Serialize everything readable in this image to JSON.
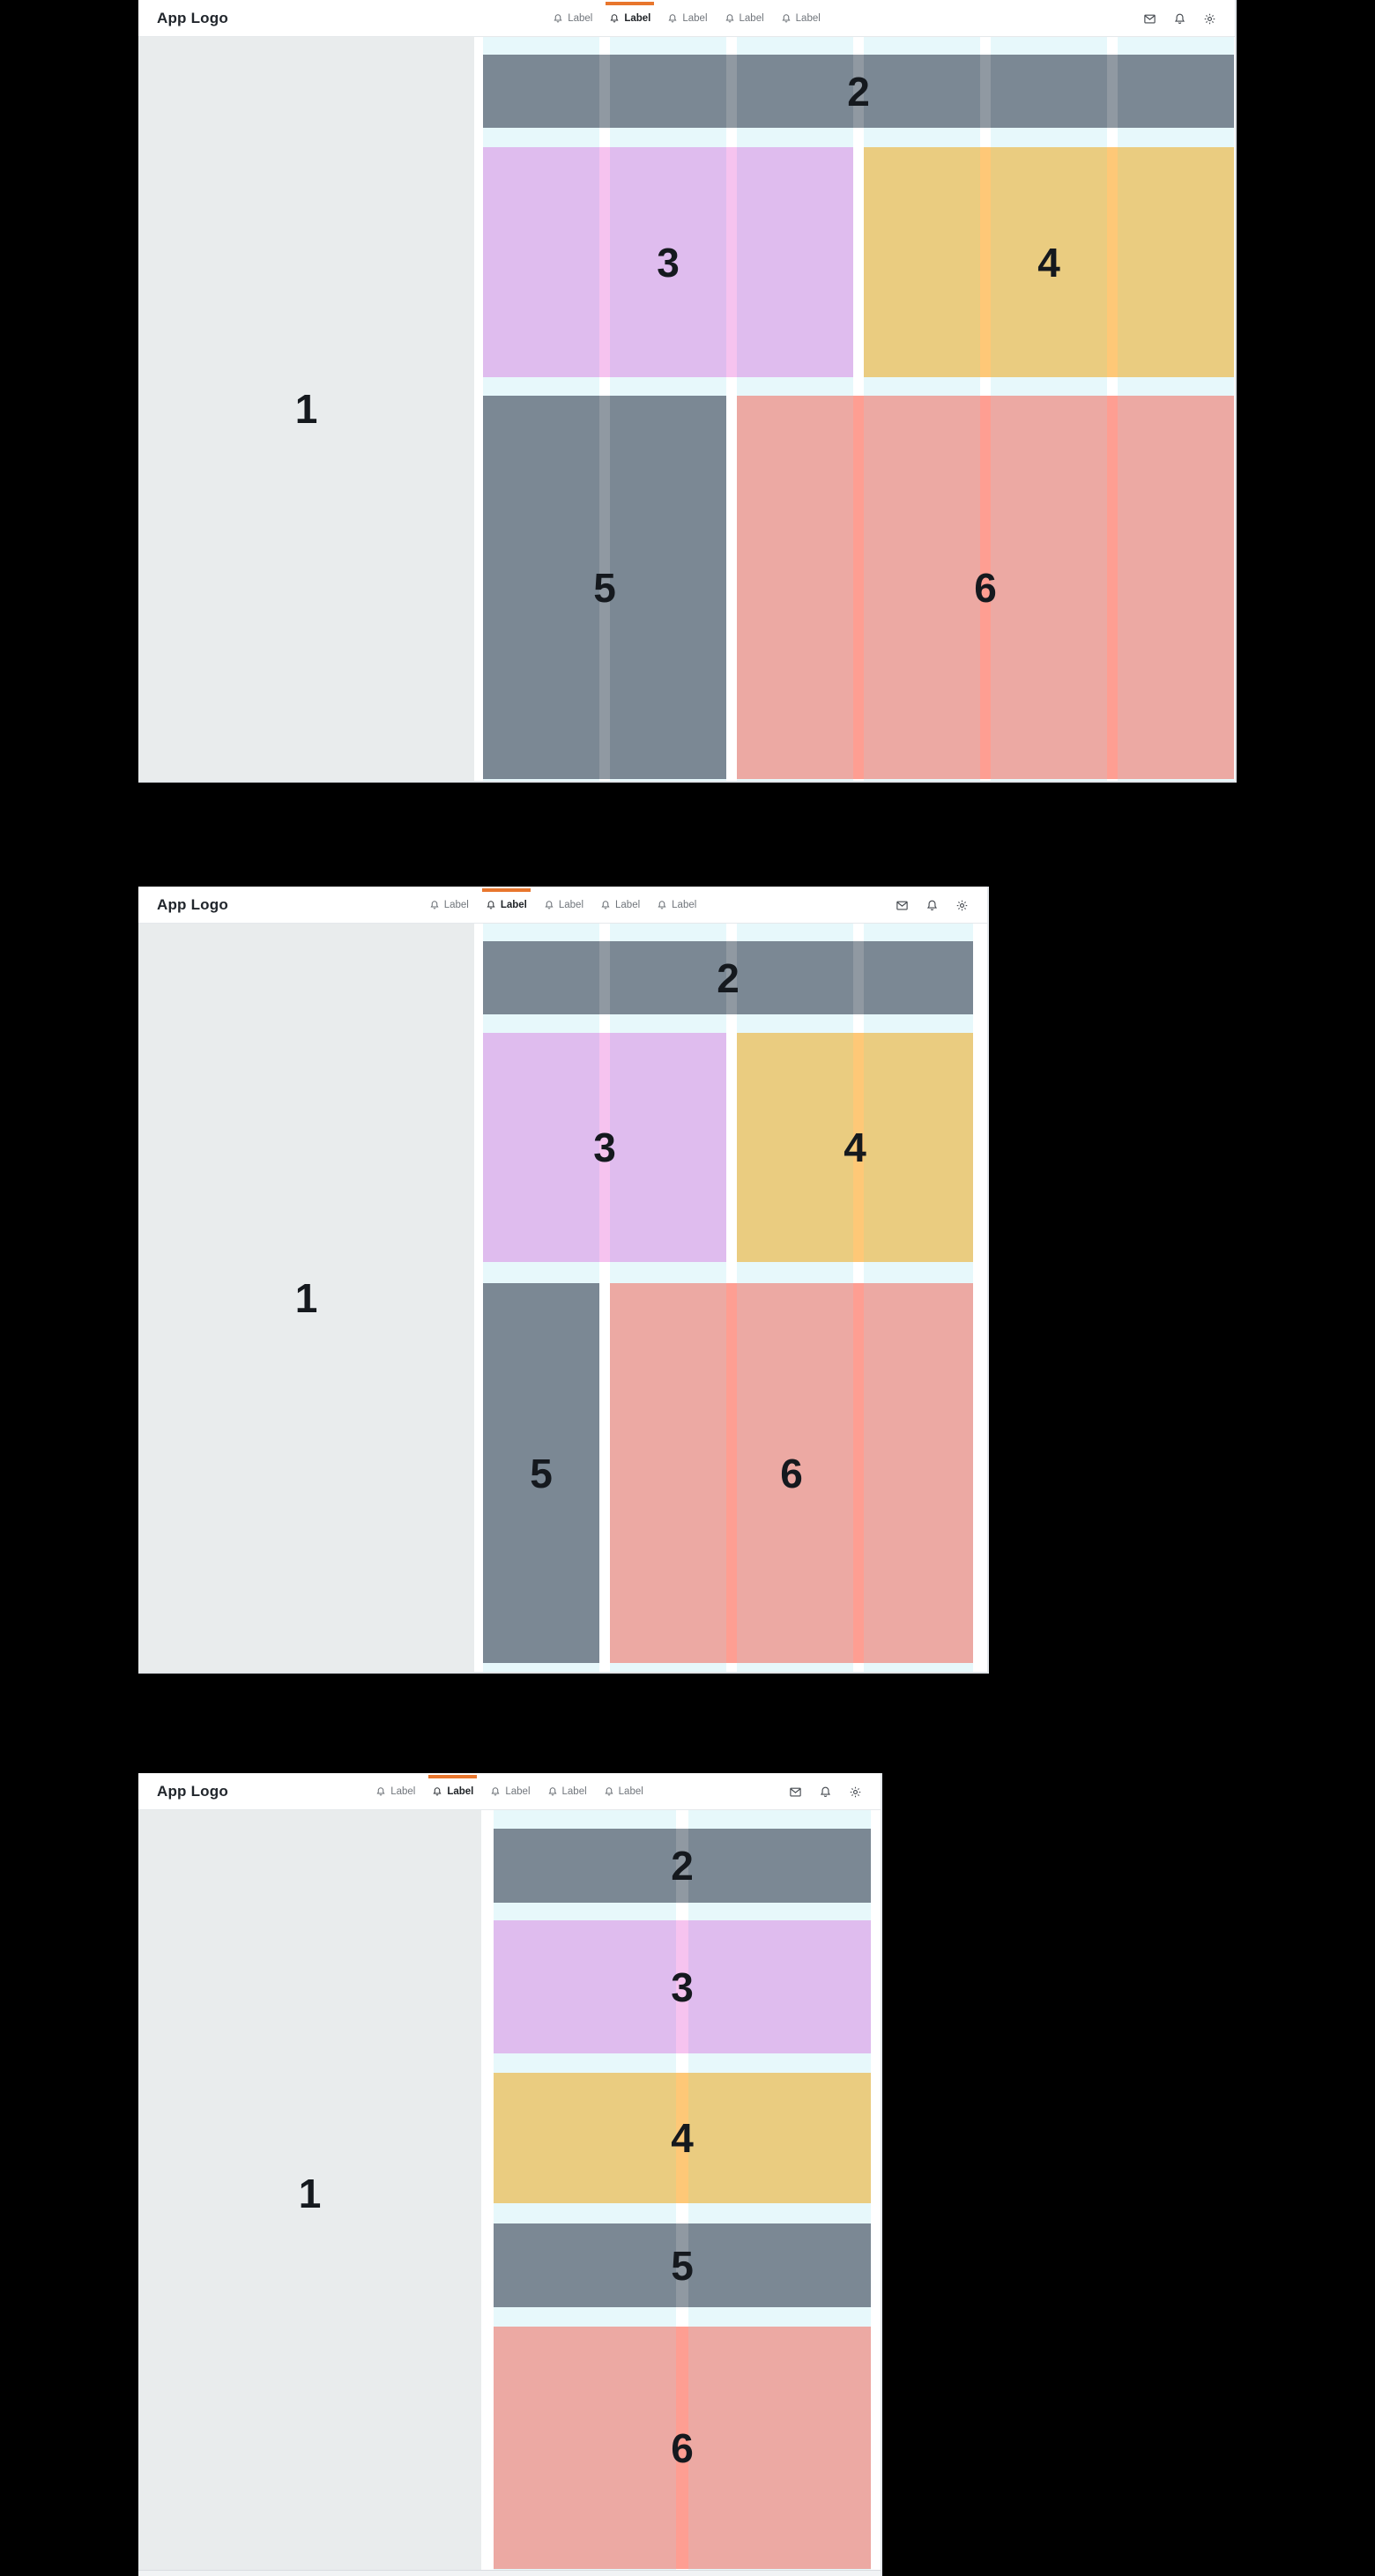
{
  "theme": {
    "accent_orange": "#e8762d",
    "block_gray": "#7b8894",
    "block_purple": "#dfbcee",
    "block_yellow": "#eacc80",
    "block_red": "#eca9a3",
    "stripe_purple": "#f6c3ef",
    "stripe_yellow": "#fec877",
    "stripe_red": "#fe9e92",
    "sidebar_gray": "#e9eced",
    "grid_column_cyan": "#e7f8fb",
    "canvas_background": "#000000"
  },
  "header": {
    "logo": "App Logo",
    "nav": [
      {
        "label": "Label",
        "active": false
      },
      {
        "label": "Label",
        "active": true
      },
      {
        "label": "Label",
        "active": false
      },
      {
        "label": "Label",
        "active": false
      },
      {
        "label": "Label",
        "active": false
      }
    ],
    "action_icons": [
      "mail-icon",
      "bell-icon",
      "gear-icon"
    ]
  },
  "regions": {
    "sidebar": "1",
    "top_band": "2",
    "panel_3": "3",
    "panel_4": "4",
    "panel_5": "5",
    "panel_6": "6"
  }
}
